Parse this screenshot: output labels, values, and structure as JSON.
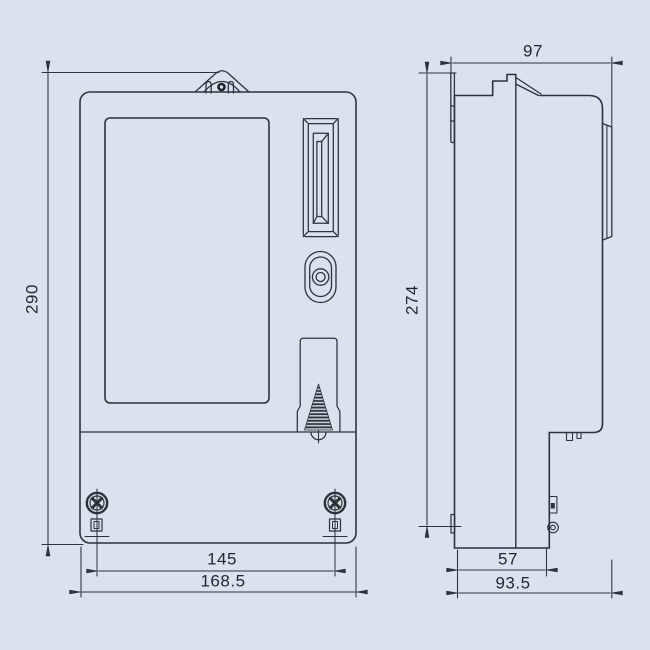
{
  "drawing": {
    "kind": "dimensional-drawing",
    "subject": "electric energy meter, front view and side view",
    "background_color": "#d9e2ee",
    "line_color": "#2e3338",
    "text_color": "#23282d"
  },
  "dims": {
    "front_height": "290",
    "screw_spacing": "145",
    "front_width": "168.5",
    "side_depth_top": "97",
    "mounting_height": "274",
    "terminal_depth": "57",
    "overall_depth": "93.5"
  }
}
